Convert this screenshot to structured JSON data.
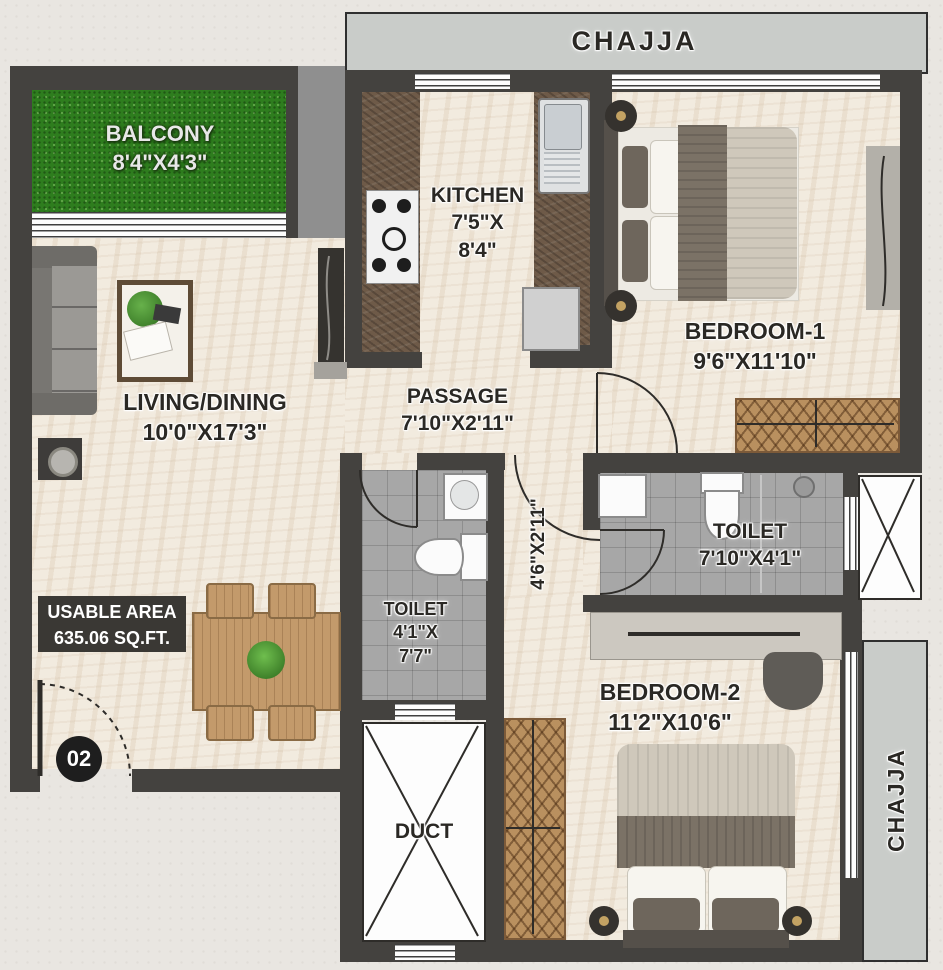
{
  "chajja_top": {
    "label": "CHAJJA"
  },
  "chajja_right": {
    "label": "CHAJJA"
  },
  "unit_badge": "02",
  "usable_area": {
    "line1": "USABLE AREA",
    "line2": "635.06 SQ.FT."
  },
  "duct": {
    "label": "DUCT"
  },
  "inner_passage_dim": "4'6\"X2'11\"",
  "rooms": {
    "balcony": {
      "name": "BALCONY",
      "dims": "8'4\"X4'3\""
    },
    "kitchen": {
      "name": "KITCHEN",
      "dims1": "7'5\"X",
      "dims2": "8'4\""
    },
    "bedroom1": {
      "name": "BEDROOM-1",
      "dims": "9'6\"X11'10\""
    },
    "living": {
      "name": "LIVING/DINING",
      "dims": "10'0\"X17'3\""
    },
    "passage": {
      "name": "PASSAGE",
      "dims": "7'10\"X2'11\""
    },
    "toilet1": {
      "name": "TOILET",
      "dims1": "4'1\"X",
      "dims2": "7'7\""
    },
    "toilet2": {
      "name": "TOILET",
      "dims": "7'10\"X4'1\""
    },
    "bedroom2": {
      "name": "BEDROOM-2",
      "dims": "11'2\"X10'6\""
    }
  },
  "colors": {
    "wall": "#44423f",
    "floor": "#f2ebdf",
    "tile": "#a7a7a7",
    "grass": "#2e7d1e",
    "chajja": "#c9ccc9",
    "wood": "#c39a6b",
    "counter": "#6e5a48"
  }
}
